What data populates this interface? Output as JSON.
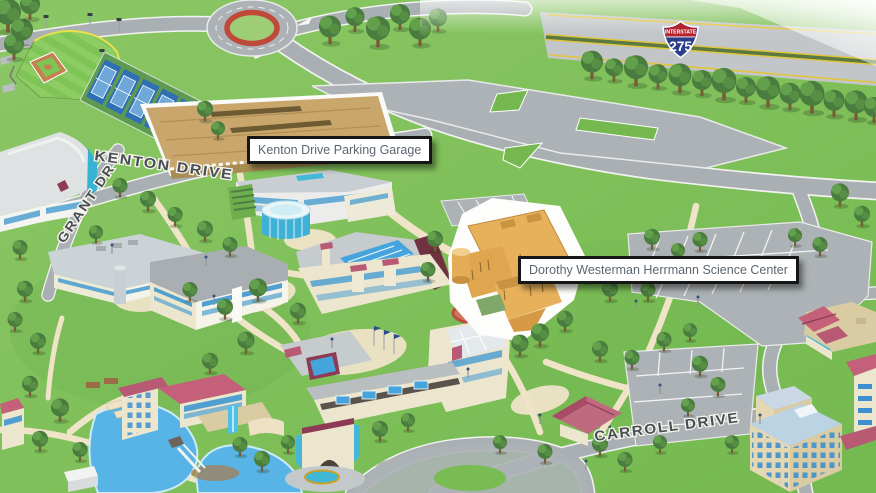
{
  "map": {
    "title": "Campus map",
    "labels": {
      "parking_garage": "Kenton Drive Parking Garage",
      "science_center": "Dorothy Westerman Herrmann Science Center"
    },
    "streets": {
      "kenton": "KENTON DRIVE",
      "grant": "GRANT DR",
      "carroll": "CARROLL DRIVE"
    },
    "shield": {
      "top": "INTERSTATE",
      "number": "275"
    },
    "features": {
      "baseball_field": "baseball field",
      "tennis_courts": "tennis courts",
      "roundabout": "roundabout",
      "lake": "campus lake",
      "highway": "Interstate 275"
    },
    "colors": {
      "grass": "#7FBE58",
      "road": "#A9AFB2",
      "path": "#EFE4C8",
      "water": "#58B4E6",
      "garage_roof": "#C9A76C",
      "highlight_building": "#E7B15C",
      "label_text": "#5C6670",
      "label_border": "#161616",
      "shield_red": "#B3242F",
      "shield_blue": "#2B3E8C",
      "street_text": "#474E54",
      "tree": "#497C3E"
    }
  }
}
